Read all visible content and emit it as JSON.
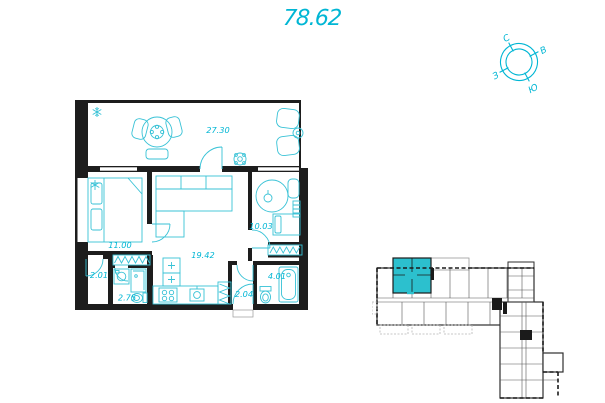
{
  "header": {
    "total_area": "78.62"
  },
  "compass": {
    "north": "С",
    "east": "В",
    "south": "Ю",
    "west": "З"
  },
  "floor_plan": {
    "rooms": [
      {
        "name": "living-room",
        "area": "27.30"
      },
      {
        "name": "bedroom",
        "area": "11.00"
      },
      {
        "name": "kitchen-living",
        "area": "19.42"
      },
      {
        "name": "bedroom-2",
        "area": "10.03"
      },
      {
        "name": "hall",
        "area": "2.01"
      },
      {
        "name": "shower-room",
        "area": "2.75"
      },
      {
        "name": "entry-hall",
        "area": "2.04"
      },
      {
        "name": "bathroom",
        "area": "4.01"
      }
    ]
  },
  "building_plan": {
    "selected_unit_highlighted": true
  },
  "icons": {
    "air_conditioner": "snowflake",
    "compass": "compass-rose"
  },
  "colors": {
    "accent_cyan": "#00B6D4",
    "furniture_cyan": "#38C2D6",
    "unit_highlight": "#2CC0CE",
    "wall_black": "#1d1d1d"
  }
}
